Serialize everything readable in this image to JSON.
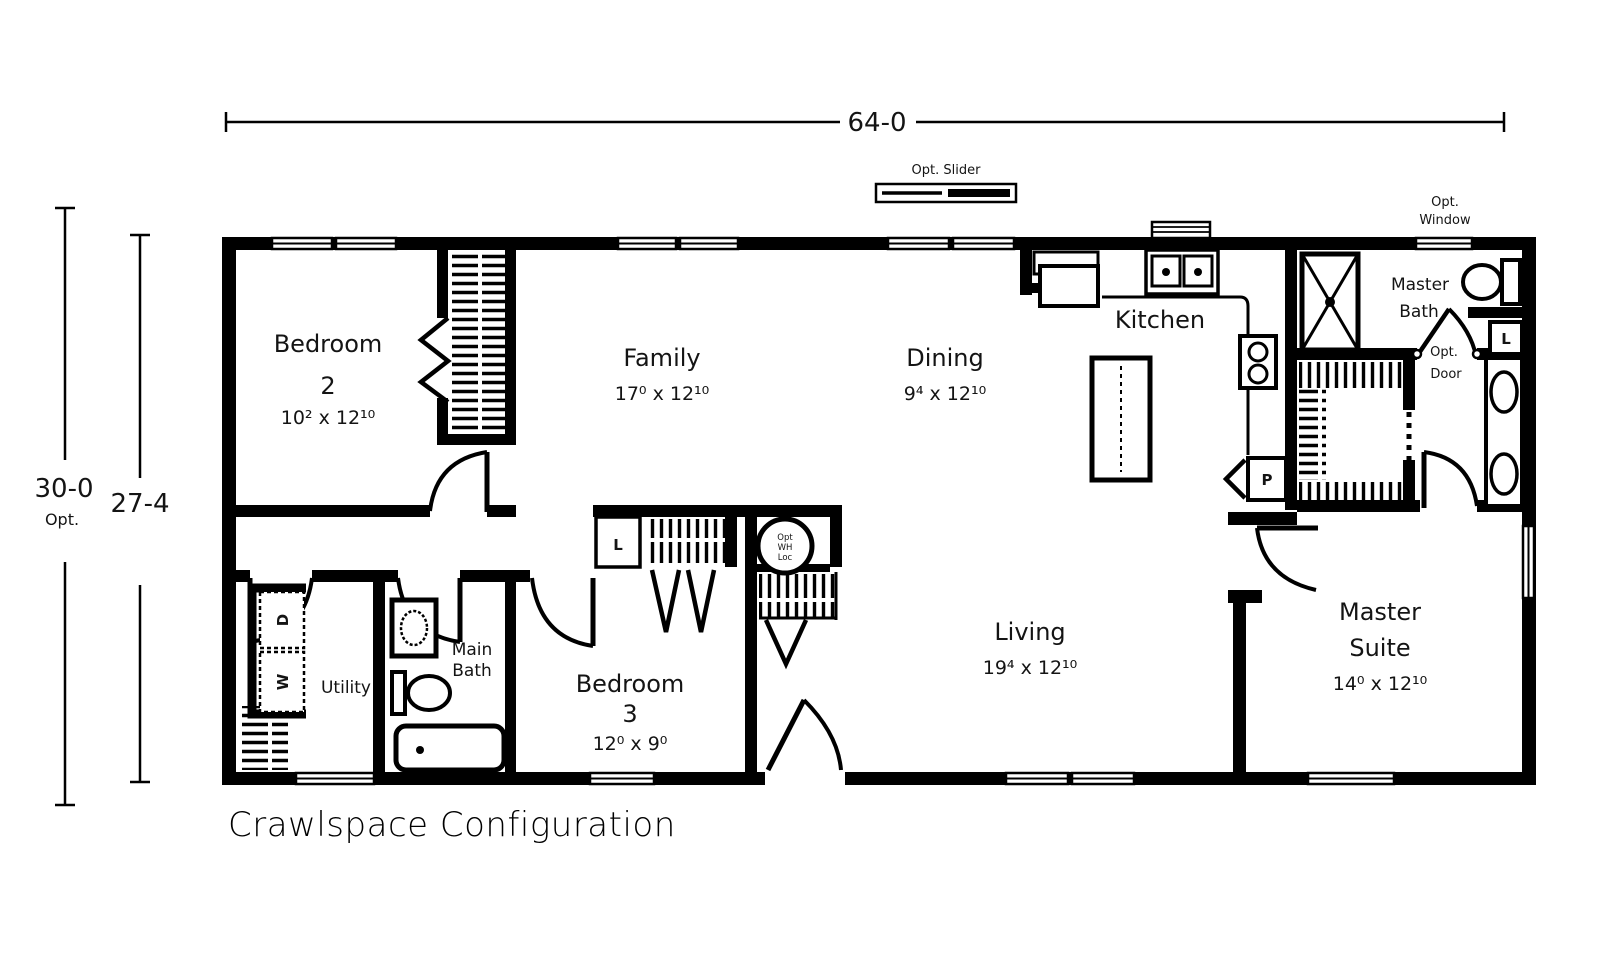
{
  "plan": {
    "title": "Crawlspace Configuration"
  },
  "dimensions": {
    "overall_width": "64-0",
    "overall_depth_opt": "30-0",
    "overall_depth_opt_note": "Opt.",
    "overall_depth": "27-4"
  },
  "rooms": {
    "bedroom2": {
      "name": "Bedroom",
      "number": "2",
      "size": "10² x 12¹⁰"
    },
    "bedroom3": {
      "name": "Bedroom",
      "number": "3",
      "size": "12⁰ x 9⁰"
    },
    "family": {
      "name": "Family",
      "size": "17⁰ x 12¹⁰"
    },
    "dining": {
      "name": "Dining",
      "size": "9⁴ x 12¹⁰"
    },
    "kitchen": {
      "name": "Kitchen"
    },
    "living": {
      "name": "Living",
      "size": "19⁴ x 12¹⁰"
    },
    "master_suite": {
      "name1": "Master",
      "name2": "Suite",
      "size": "14⁰ x 12¹⁰"
    },
    "master_bath": {
      "name1": "Master",
      "name2": "Bath"
    },
    "main_bath": {
      "name1": "Main",
      "name2": "Bath"
    },
    "utility": {
      "name": "Utility"
    }
  },
  "annotations": {
    "opt_slider": "Opt. Slider",
    "opt_window1": "Opt.",
    "opt_window2": "Window",
    "opt_door1": "Opt.",
    "opt_door2": "Door",
    "pantry": "P",
    "linen_hall": "L",
    "linen_master": "L",
    "dryer": "D",
    "washer": "W",
    "water_heater1": "Opt",
    "water_heater2": "WH",
    "water_heater3": "Loc"
  },
  "colors": {
    "line": "#000000",
    "background": "#ffffff"
  }
}
